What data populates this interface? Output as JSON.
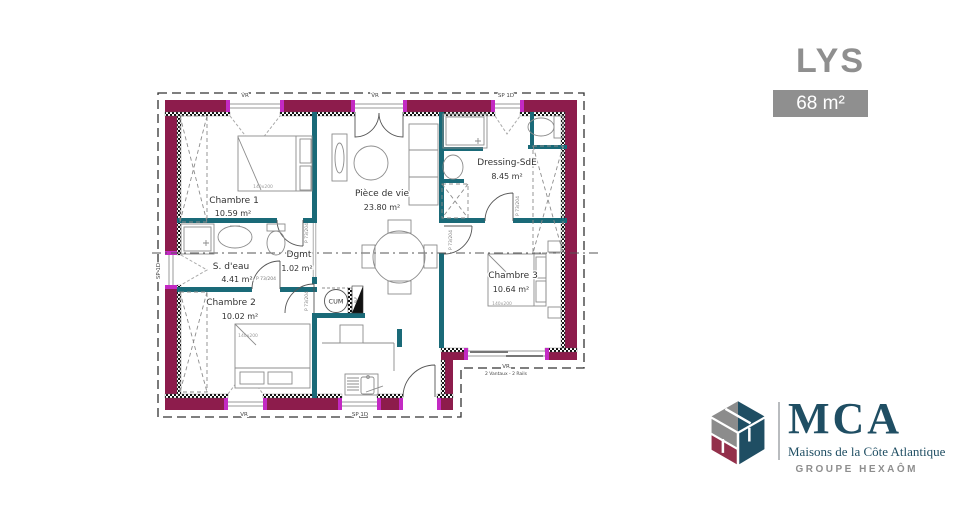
{
  "header": {
    "model": "LYS",
    "surface": "68 m²"
  },
  "plan": {
    "rooms": [
      {
        "name": "Chambre 1",
        "area": "10.59 m²"
      },
      {
        "name": "S. d'eau",
        "area": "4.41 m²"
      },
      {
        "name": "Chambre 2",
        "area": "10.02 m²"
      },
      {
        "name": "Dgmt",
        "area": "1.02 m²"
      },
      {
        "name": "Pièce de vie",
        "area": "23.80 m²"
      },
      {
        "name": "Dressing-SdE",
        "area": "8.45 m²"
      },
      {
        "name": "Chambre 3",
        "area": "10.64 m²"
      }
    ],
    "labels": {
      "door": "P 73/204",
      "bed": "140x200",
      "roller_shutter": "VR",
      "single_leaf": "SP 1D",
      "bay": "2 Vantaux - 2 Rails",
      "water_heater": "CUM",
      "duct": "SLF"
    },
    "colors": {
      "exterior_wall": "#8D1C4C",
      "opening_accent": "#C32AC3",
      "partition": "#1A6A78"
    }
  },
  "brand": {
    "initials": "MCA",
    "tagline": "Maisons de la Côte Atlantique",
    "group": "GROUPE HEXAÔM",
    "blue": "#1F4E63",
    "maroon": "#93304B",
    "gray": "#8F8F8F"
  }
}
